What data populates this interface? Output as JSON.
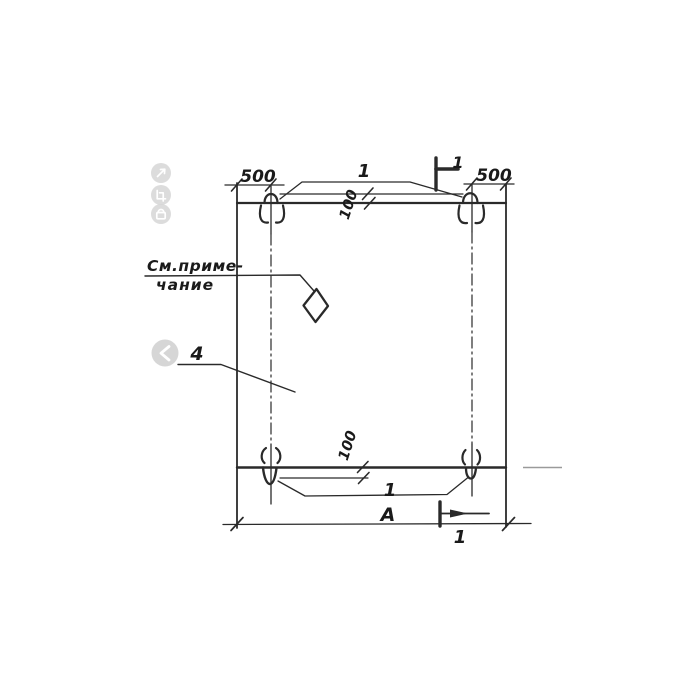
{
  "drawing": {
    "labels": {
      "dim_500_left": "500",
      "dim_500_right": "500",
      "callout_top": "1",
      "section_top": "1",
      "dim_100_top": "100",
      "note_line1": "См.приме-",
      "note_line2": "чание",
      "part_number": "4",
      "dim_100_bottom": "100",
      "callout_bottom": "1",
      "dim_width": "А",
      "section_bottom": "1"
    }
  },
  "viewer": {
    "icons": [
      {
        "name": "expand-icon"
      },
      {
        "name": "crop-icon"
      },
      {
        "name": "lock-icon"
      },
      {
        "name": "chevron-left-icon"
      }
    ]
  },
  "colors": {
    "line": "#2a2a2a",
    "faint_line": "#9a9a9a",
    "icon_bg": "#d6d6d6",
    "icon_glyph": "#ffffff",
    "background": "#ffffff"
  }
}
